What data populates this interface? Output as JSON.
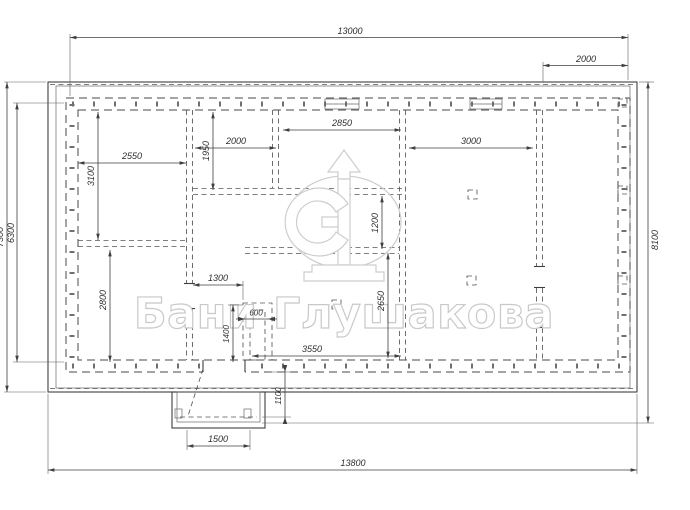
{
  "watermark": {
    "brand": "Бани Глушакова"
  },
  "dimensions_mm": {
    "dim_top_width": "13000",
    "dim_top_right_offset": "2000",
    "dim_left_outer_depth": "7300",
    "dim_left_inner_depth": "6300",
    "dim_right_depth": "8100",
    "dim_bottom_width": "13800",
    "dim_porch_width": "1500",
    "dim_porch_depth": "1100",
    "dim_room_tl_width": "2550",
    "dim_room_tl_depth": "3100",
    "dim_room_bl_depth": "2800",
    "dim_room_tm_depth": "1950",
    "dim_room_tm_width": "2000",
    "dim_room_tc_width": "2850",
    "dim_room_mr_width": "3000",
    "dim_passage_depth": "1200",
    "dim_corridor_width": "1300",
    "dim_stove_width": "600",
    "dim_stove_depth": "1400",
    "dim_room_bm_width": "3550",
    "dim_room_bm_depth": "2650"
  },
  "colors": {
    "line": "#3f3f3f",
    "watermark": "#cdcdcd",
    "background": "#ffffff"
  }
}
